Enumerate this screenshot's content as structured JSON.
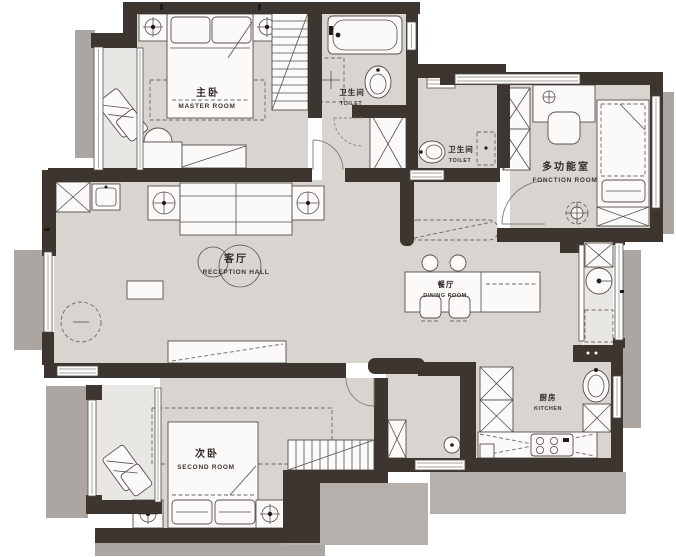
{
  "document": {
    "title": "三居室户型平面图",
    "type": "floor plan"
  },
  "palette": {
    "wall": "#3d352f",
    "floor": "#d8d4d0",
    "balcony_floor": "#e9e7e3",
    "shadow": "#aca6a2",
    "furniture": "#fbfaf8",
    "background": "#ffffff",
    "text": "#2f2b27"
  },
  "rooms": [
    {
      "id": "master-room",
      "name_zh": "主卧",
      "name_en": "MASTER ROOM"
    },
    {
      "id": "toilet-main",
      "name_zh": "卫生间",
      "name_en": "TOILET"
    },
    {
      "id": "toilet-second",
      "name_zh": "卫生间",
      "name_en": "TOILET"
    },
    {
      "id": "function-room",
      "name_zh": "多功能室",
      "name_en": "FONCTION ROOM"
    },
    {
      "id": "reception-hall",
      "name_zh": "客厅",
      "name_en": "RECEPTION HALL"
    },
    {
      "id": "dining-room",
      "name_zh": "餐厅",
      "name_en": "DINING ROOM"
    },
    {
      "id": "kitchen",
      "name_zh": "厨房",
      "name_en": "KITCHEN"
    },
    {
      "id": "second-room",
      "name_zh": "次卧",
      "name_en": "SECOND ROOM"
    }
  ]
}
